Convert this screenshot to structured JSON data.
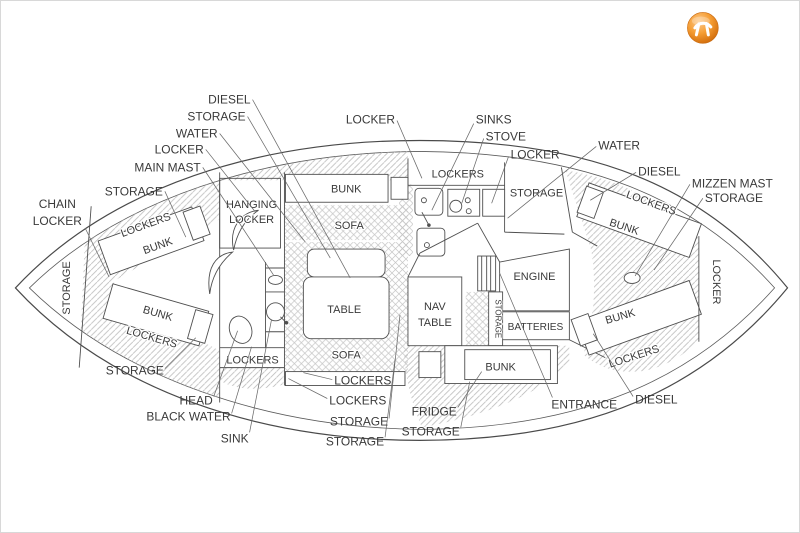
{
  "diagram_title": "sailboat-interior-layout-plan",
  "colors": {
    "line": "#4f4f4f",
    "text": "#3a3a3a",
    "hatch_diag": "#bdbdbd",
    "hatch_cross": "#c4c4c4",
    "logo_orange": "#e8821a",
    "background": "#ffffff"
  },
  "labels": {
    "tl_diesel": "DIESEL",
    "tl_storage": "STORAGE",
    "tl_water": "WATER",
    "tl_locker": "LOCKER",
    "tl_main_mast": "MAIN MAST",
    "tl_storage2": "STORAGE",
    "chain_line1": "CHAIN",
    "chain_line2": "LOCKER",
    "tc_locker": "LOCKER",
    "tc_sinks": "SINKS",
    "tc_stove": "STOVE",
    "tc_locker2": "LOCKER",
    "tc_water": "WATER",
    "r_diesel": "DIESEL",
    "r_mizzen_mast": "MIZZEN MAST",
    "r_storage": "STORAGE",
    "b_storage_left": "STORAGE",
    "b_head": "HEAD",
    "b_black_water": "BLACK WATER",
    "b_sink": "SINK",
    "b_lockers1": "LOCKERS",
    "b_lockers2": "LOCKERS",
    "b_storage1": "STORAGE",
    "b_storage2": "STORAGE",
    "b_fridge": "FRIDGE",
    "b_storage3": "STORAGE",
    "b_entrance": "ENTRANCE",
    "b_diesel": "DIESEL",
    "in_bow_storage": "STORAGE",
    "in_bow_lockers_top": "LOCKERS",
    "in_bow_bunk_top": "BUNK",
    "in_bow_bunk_bot": "BUNK",
    "in_bow_lockers_bot": "LOCKERS",
    "in_hanging1": "HANGING",
    "in_hanging2": "LOCKER",
    "in_head_lockers": "LOCKERS",
    "in_salon_bunk": "BUNK",
    "in_sofa_top": "SOFA",
    "in_table": "TABLE",
    "in_sofa_bottom": "SOFA",
    "in_galley_lockers": "LOCKERS",
    "in_galley_storage": "STORAGE",
    "in_nav1": "NAV",
    "in_nav2": "TABLE",
    "in_engine": "ENGINE",
    "in_batteries": "BATTERIES",
    "in_storage_strip": "STORAGE",
    "in_quarter_bunk": "BUNK",
    "in_aft_lockers_top": "LOCKERS",
    "in_aft_bunk_top": "BUNK",
    "in_aft_bunk_bot": "BUNK",
    "in_aft_lockers_bot": "LOCKERS",
    "in_stern_locker": "LOCKER"
  }
}
